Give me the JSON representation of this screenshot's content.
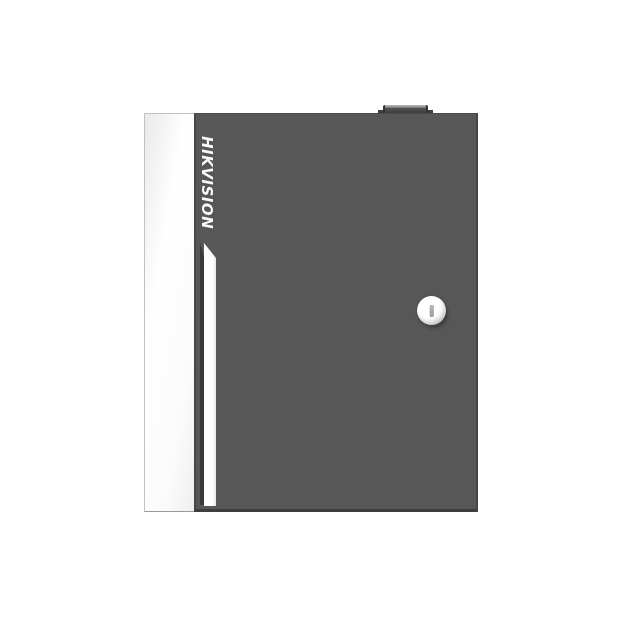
{
  "image": {
    "width": 620,
    "height": 620
  },
  "device": {
    "brand_label": "HIKVISION",
    "lock_icon": "keyhole-icon",
    "colors": {
      "background": "#ffffff",
      "door": "#575757",
      "door_edge_dark": "#3e3e3e",
      "side_panel": "#fbfbfb",
      "panel_border": "#c2c2c2",
      "stripe": "#fdfdfd",
      "stripe_groove": "#3a3a3a",
      "brand_text": "#fafafa",
      "lock_face": "#ffffff",
      "keyhole": "#a0a0a0",
      "knob": "#454545"
    }
  }
}
